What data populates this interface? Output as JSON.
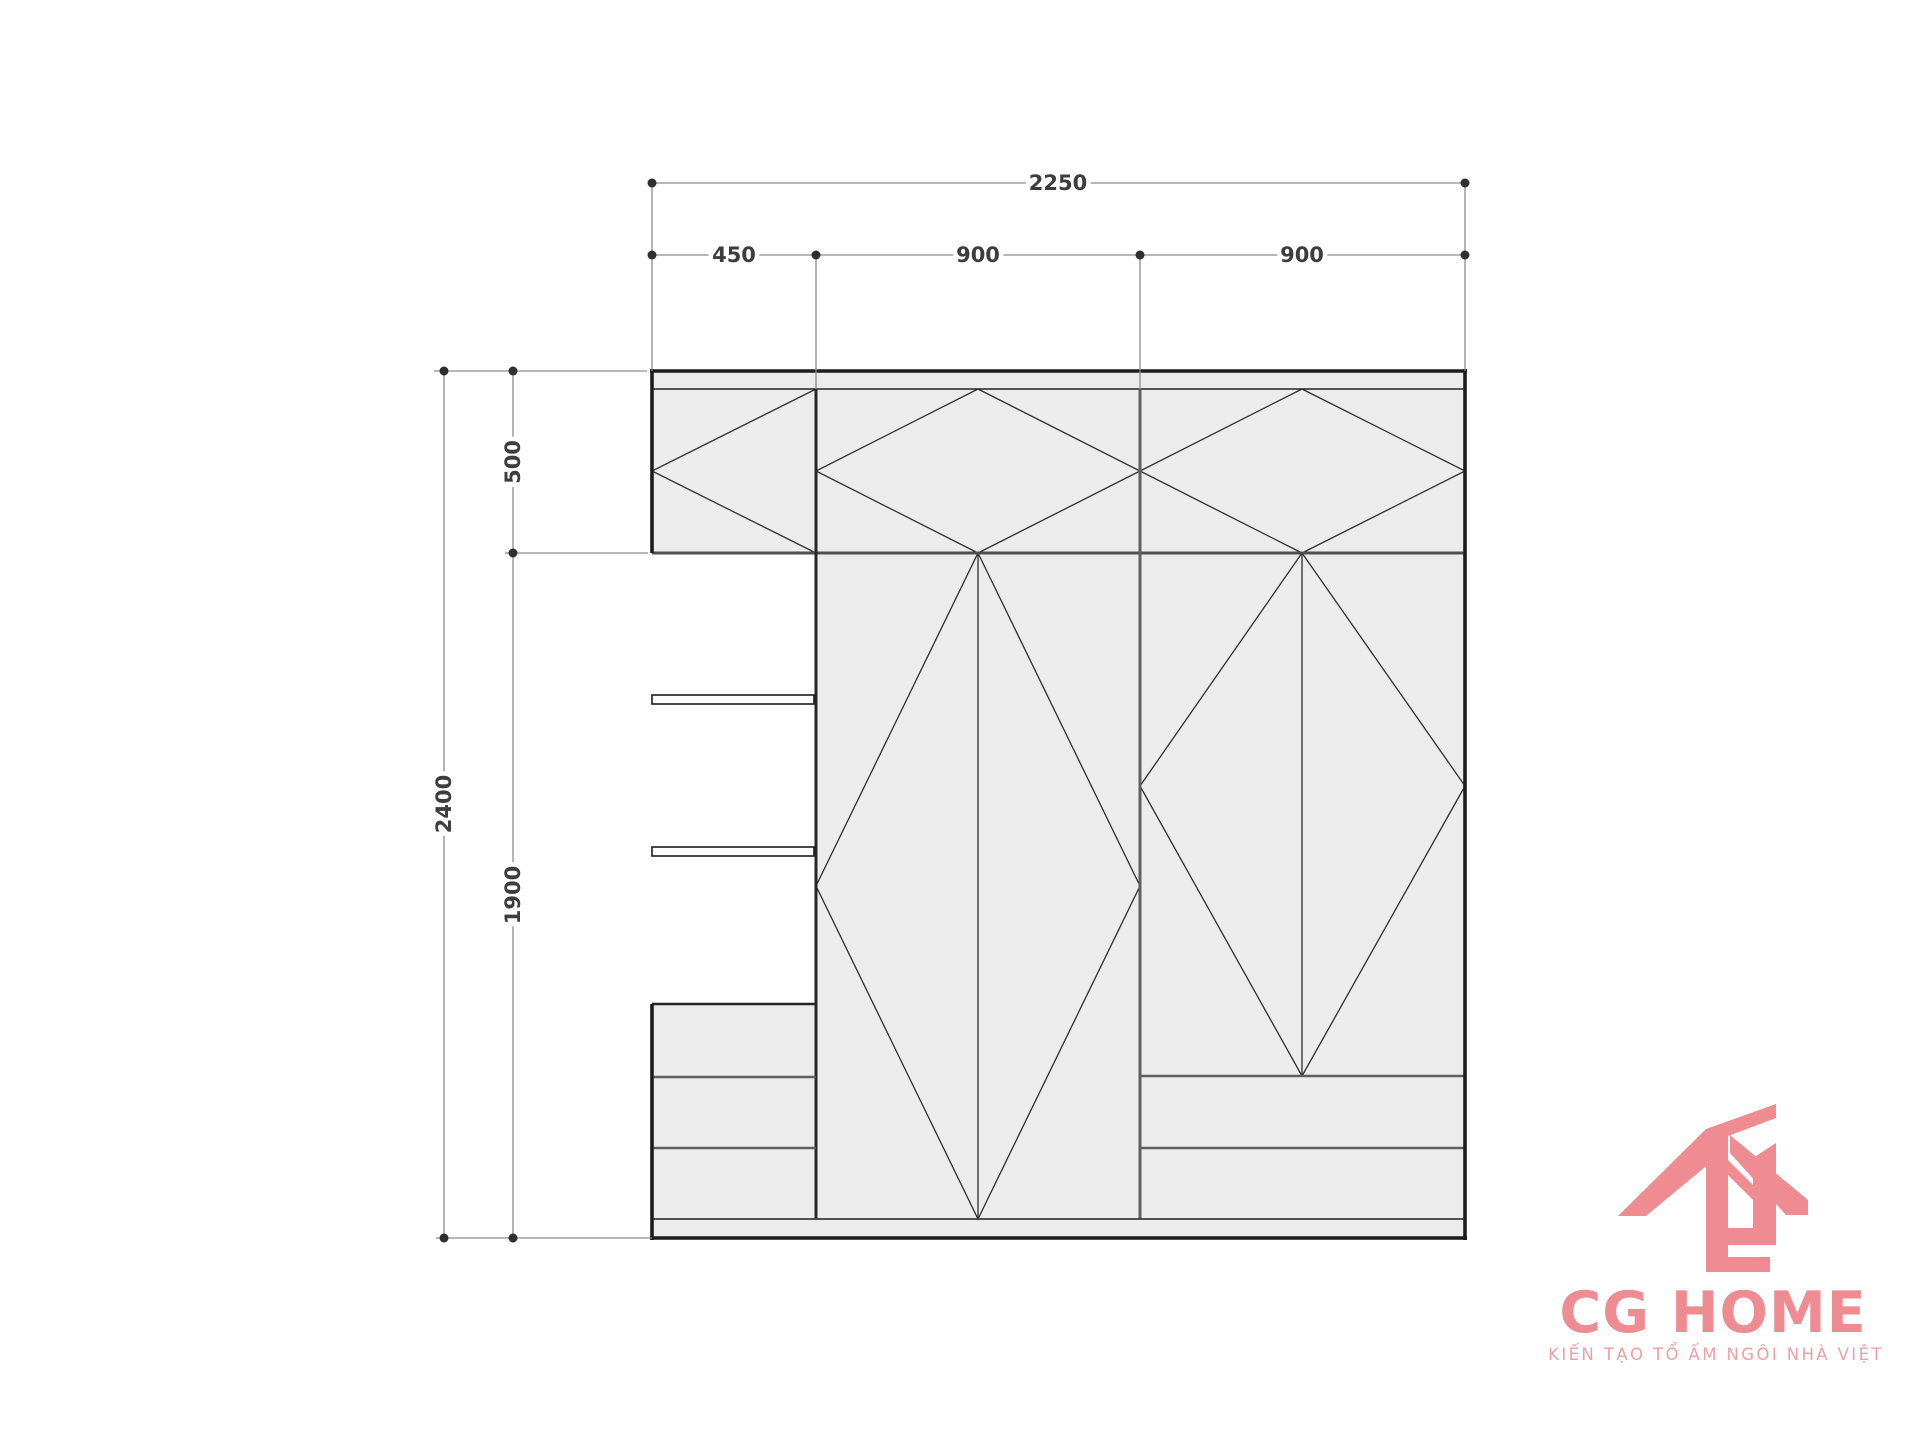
{
  "drawing": {
    "name": "wardrobe-elevation-drawing",
    "dimensions": {
      "total_width": "2250",
      "width_segments": [
        "450",
        "900",
        "900"
      ],
      "total_height": "2400",
      "height_segments": [
        "500",
        "1900"
      ]
    }
  },
  "logo": {
    "brand": "CG HOME",
    "tagline": "KIẾN TẠO TỔ ẤM NGÔI NHÀ VIỆT"
  },
  "colors": {
    "background": "#ffffff",
    "panel_fill": "#ececec",
    "outline_dark": "#1c1c1c",
    "line_medium": "#5f5f5f",
    "pattern_line": "#2e2e2e",
    "dim_line": "#8c8c8c",
    "dim_text": "#3d3d3d",
    "brand_pink": "#ee8c91",
    "tagline_pink": "#eda0a4"
  }
}
